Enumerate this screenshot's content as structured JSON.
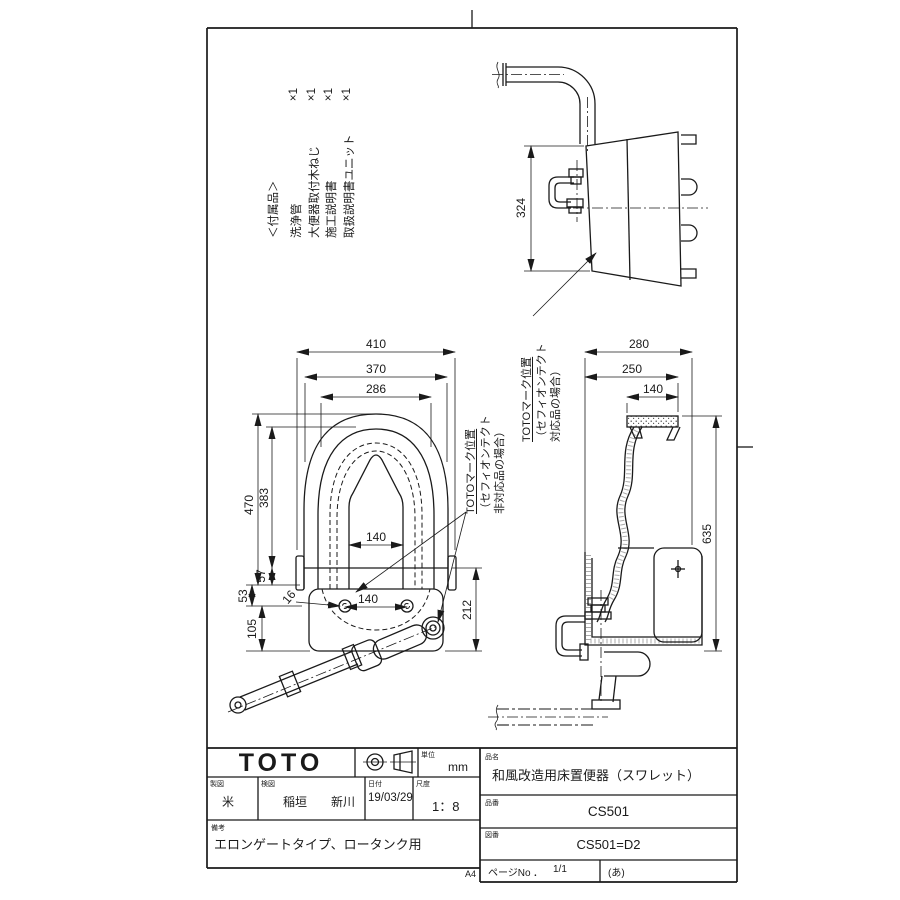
{
  "accessories": {
    "title": "＜付属品＞",
    "items": [
      {
        "name": "洗浄管",
        "qty": "×1"
      },
      {
        "name": "大便器取付木ねじ",
        "qty": "×1"
      },
      {
        "name": "施工説明書",
        "qty": "×1"
      },
      {
        "name": "取扱説明書ユニット",
        "qty": "×1"
      }
    ]
  },
  "annotations": {
    "mark_title": "TOTOマーク位置",
    "mark_line2": "（セフィオンテクト",
    "mark_compatible": "対応品の場合）",
    "mark_incompatible": "非対応品の場合）"
  },
  "dimensions": {
    "plan": {
      "overall_width": "410",
      "rim_width": "370",
      "seat_width": "286",
      "overall_depth": "470",
      "seat_depth": "383",
      "inner_width": "140",
      "hinge_gap": "57",
      "rear_gap": "53",
      "base_depth": "105",
      "bolt_pitch": "140",
      "bolt_hole": "16",
      "rear_section": "212"
    },
    "front": {
      "height": "324"
    },
    "side": {
      "overall_depth": "280",
      "rim_depth": "250",
      "top_depth": "140",
      "height": "635"
    }
  },
  "title_block": {
    "logo": "TOTO",
    "unit_label": "単位",
    "unit_value": "mm",
    "drafter_label": "製図",
    "drafter": "米",
    "checker_label": "検図",
    "checker_a": "稲垣",
    "checker_b": "新川",
    "date_label": "日付",
    "date": "19/03/29",
    "scale_label": "尺度",
    "scale": "1：8",
    "remarks_label": "備考",
    "remarks": "エロンゲートタイプ、ロータンク用",
    "product_name_label": "品名",
    "product_name": "和風改造用床置便器（スワレット）",
    "product_number_label": "品番",
    "product_number": "CS501",
    "drawing_number_label": "図番",
    "drawing_number": "CS501=D2",
    "page_label": "ページNo",
    "page_dot": "．",
    "page_value": "1/1",
    "page_note": "(あ)",
    "paper_size": "A4"
  }
}
